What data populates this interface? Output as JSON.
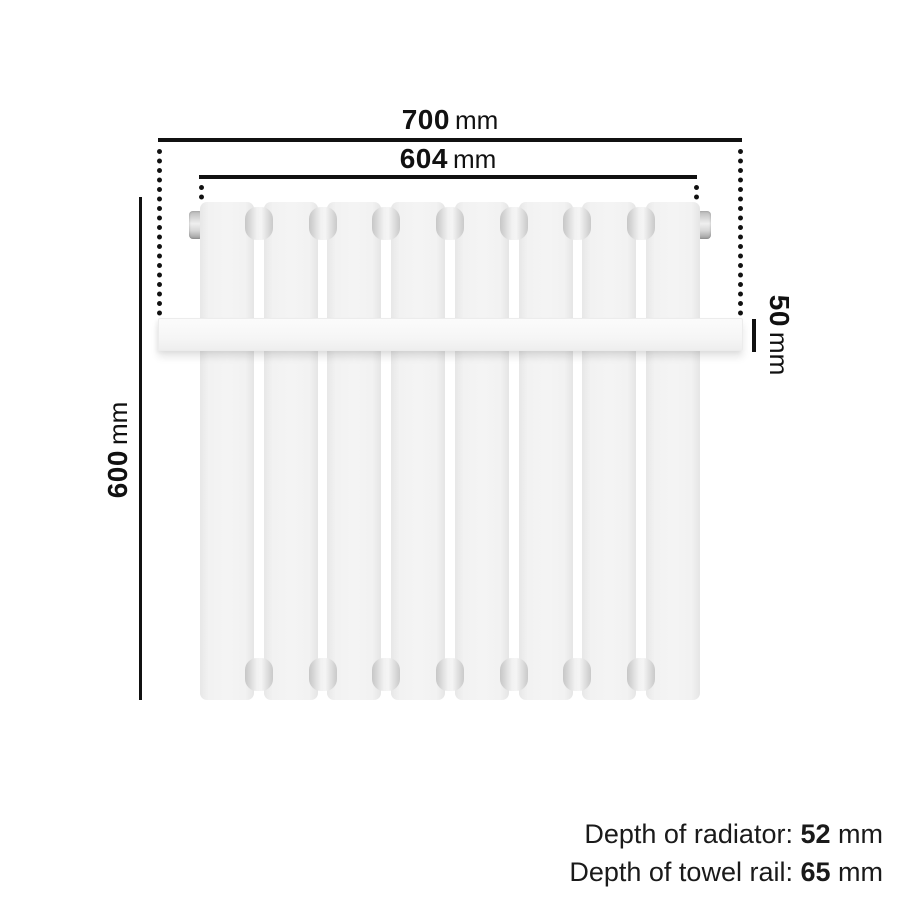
{
  "dimensions": {
    "overall_width": {
      "value": "700",
      "unit": "mm"
    },
    "radiator_width": {
      "value": "604",
      "unit": "mm"
    },
    "height": {
      "value": "600",
      "unit": "mm"
    },
    "rail_height": {
      "value": "50",
      "unit": "mm"
    }
  },
  "depth_notes": [
    {
      "label": "Depth of radiator: ",
      "value": "52",
      "unit": " mm"
    },
    {
      "label": "Depth of towel rail: ",
      "value": "65",
      "unit": " mm"
    }
  ],
  "radiator": {
    "panel_count": 8
  },
  "colors": {
    "line": "#111111",
    "panel": "#f2f2f2",
    "rail": "#f7f7f7",
    "background": "#ffffff"
  }
}
